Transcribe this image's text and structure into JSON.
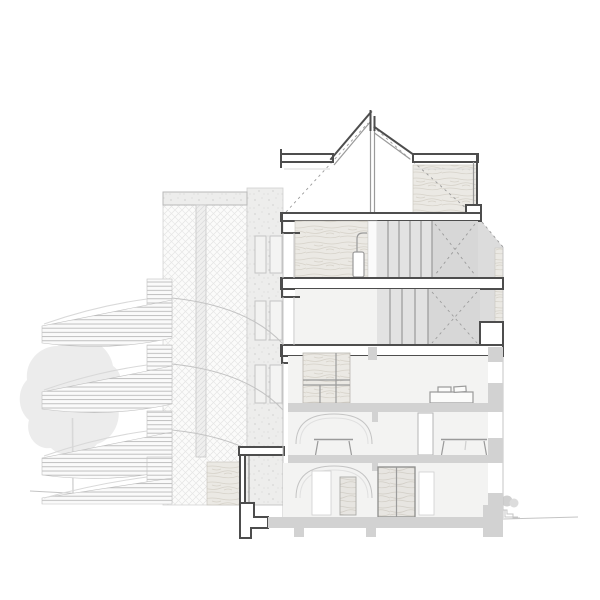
{
  "document": {
    "kind": "architectural cross-section drawing, no visible text",
    "background": "#ffffff"
  },
  "palette": {
    "paper": "#ffffff",
    "cut_line": "#4d4d4d",
    "mid_line": "#9a9a9a",
    "light_line": "#c4c4c4",
    "faint_line": "#d9d9d9",
    "room_fill": "#f3f3f2",
    "panel_gray": "#e2e2e2",
    "panel_gray_dark": "#d7d7d7",
    "slab_gray": "#d2d2d2",
    "bay_gray": "#dcdcdc",
    "tree_gray": "#ececec",
    "bush_gray": "#d0d0d0",
    "wood_bg": "#ebe9e4",
    "wood_line": "#d6d2c9",
    "concrete_bg": "#ededec",
    "hatch_line": "#e3e3e3"
  },
  "scene": {
    "site": [
      "tree",
      "ground-line-left",
      "ground-line-right",
      "bush",
      "exterior-steps"
    ],
    "left_structure": [
      "trellis-panel",
      "top-parapet",
      "support-post",
      "spiral-stair-flights",
      "concrete-pier",
      "facade-windows",
      "balcony-slab",
      "wood-clad-base",
      "foundation-footing"
    ],
    "building": {
      "roof": [
        "left-flat-roof",
        "gable-left-slope",
        "ridge-post",
        "gable-right-slope",
        "right-flat-roof",
        "attic-plywood-wall",
        "rafter-dashed-lines"
      ],
      "floor4": [
        "plywood-wall",
        "water-heater",
        "stair-balustrade",
        "bay-window-chamfer"
      ],
      "floor3": [
        "stair-balustrade",
        "bay-window-cut"
      ],
      "floor2": [
        "wardrobe",
        "bed",
        "facade-pier"
      ],
      "floor1": [
        "vaulted-ceiling",
        "table-left",
        "door-opening",
        "table-right"
      ],
      "ground_floor": [
        "vaulted-ceiling",
        "window-opening",
        "wood-door-narrow",
        "wood-double-door",
        "door-opening-right",
        "ground-slab",
        "foundation-piers"
      ]
    }
  }
}
